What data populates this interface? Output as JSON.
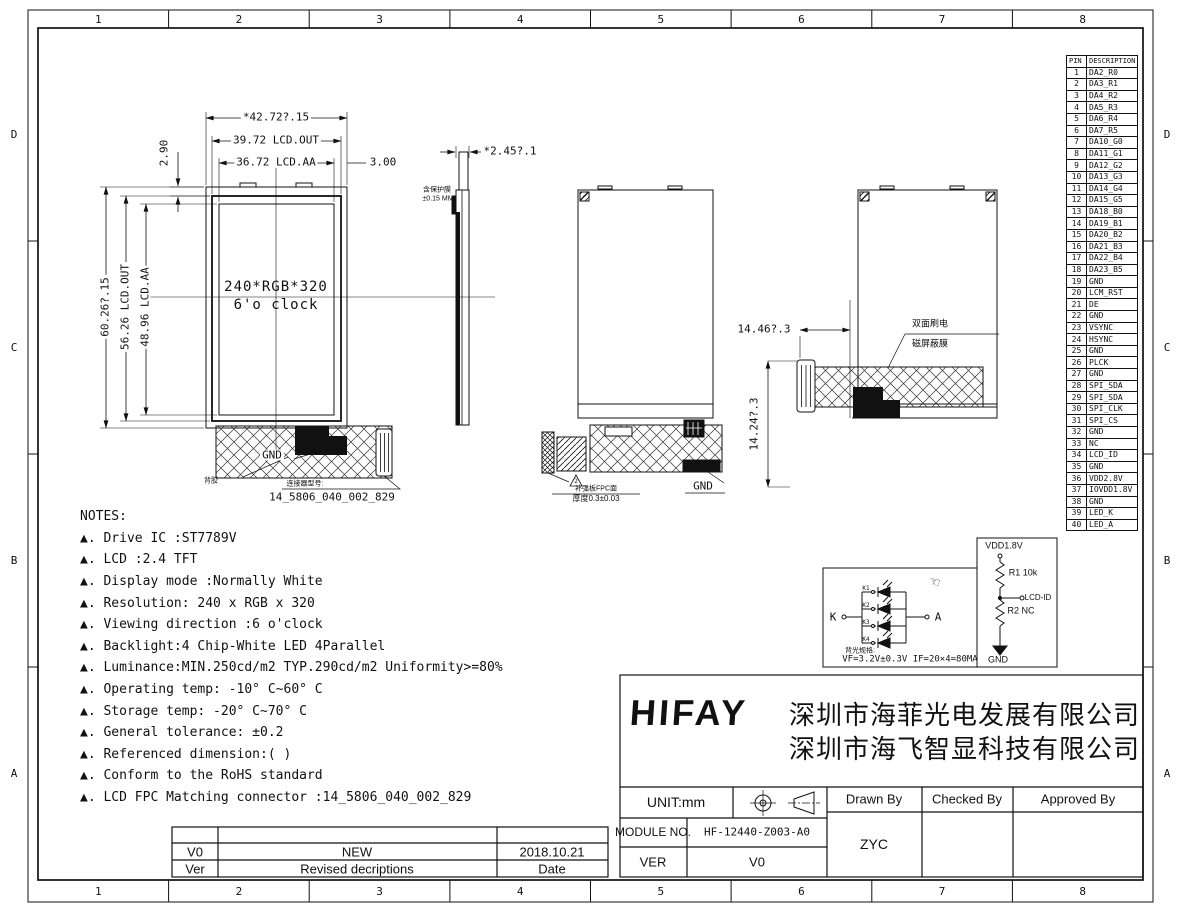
{
  "frame": {
    "cols": [
      "1",
      "2",
      "3",
      "4",
      "5",
      "6",
      "7",
      "8"
    ],
    "rows": [
      "D",
      "C",
      "B",
      "A"
    ]
  },
  "front_view": {
    "dim_width_total": "*42.72?.15",
    "dim_width_out": "39.72 LCD.OUT",
    "dim_width_aa": "36.72 LCD.AA",
    "dim_right_margin": "3.00",
    "dim_top": "2.90",
    "dim_height_total": "60.26?.15",
    "dim_height_out": "56.26 LCD.OUT",
    "dim_height_aa": "48.96 LCD.AA",
    "center_line1": "240*RGB*320",
    "center_line2": "6'o clock",
    "gnd_label": "GND",
    "adhesive_label": "背胶",
    "connector_label": "连接器型号:",
    "connector_pn": "14_5806_040_002_829"
  },
  "side_view": {
    "dim_thickness": "*2.45?.1",
    "note_line1": "含保护膜",
    "note_line2": "±0.15 MM"
  },
  "fold_view": {
    "gnd_label": "GND",
    "warn_num": "2",
    "fpc_note1": "补强板FPC面",
    "fpc_note2": "厚度0.3±0.03"
  },
  "shield_view": {
    "dim_h": "14.46?.3",
    "dim_v": "14.24?.3",
    "label_line1": "双面刷电",
    "label_line2": "磁屏蔽膜"
  },
  "pin_table": {
    "headers": [
      "PIN",
      "DESCRIPTION"
    ],
    "rows": [
      {
        "pin": "1",
        "desc": "DA2_R0"
      },
      {
        "pin": "2",
        "desc": "DA3_R1"
      },
      {
        "pin": "3",
        "desc": "DA4_R2"
      },
      {
        "pin": "4",
        "desc": "DA5_R3"
      },
      {
        "pin": "5",
        "desc": "DA6_R4"
      },
      {
        "pin": "6",
        "desc": "DA7_R5"
      },
      {
        "pin": "7",
        "desc": "DA10_G0"
      },
      {
        "pin": "8",
        "desc": "DA11_G1"
      },
      {
        "pin": "9",
        "desc": "DA12_G2"
      },
      {
        "pin": "10",
        "desc": "DA13_G3"
      },
      {
        "pin": "11",
        "desc": "DA14_G4"
      },
      {
        "pin": "12",
        "desc": "DA15_G5"
      },
      {
        "pin": "13",
        "desc": "DA18_B0"
      },
      {
        "pin": "14",
        "desc": "DA19_B1"
      },
      {
        "pin": "15",
        "desc": "DA20_B2"
      },
      {
        "pin": "16",
        "desc": "DA21_B3"
      },
      {
        "pin": "17",
        "desc": "DA22_B4"
      },
      {
        "pin": "18",
        "desc": "DA23_B5"
      },
      {
        "pin": "19",
        "desc": "GND"
      },
      {
        "pin": "20",
        "desc": "LCM_RST"
      },
      {
        "pin": "21",
        "desc": "DE"
      },
      {
        "pin": "22",
        "desc": "GND"
      },
      {
        "pin": "23",
        "desc": "VSYNC"
      },
      {
        "pin": "24",
        "desc": "HSYNC"
      },
      {
        "pin": "25",
        "desc": "GND"
      },
      {
        "pin": "26",
        "desc": "PLCK"
      },
      {
        "pin": "27",
        "desc": "GND"
      },
      {
        "pin": "28",
        "desc": "SPI_SDA"
      },
      {
        "pin": "29",
        "desc": "SPI_SDA"
      },
      {
        "pin": "30",
        "desc": "SPI_CLK"
      },
      {
        "pin": "31",
        "desc": "SPI_CS"
      },
      {
        "pin": "32",
        "desc": "GND"
      },
      {
        "pin": "33",
        "desc": "NC"
      },
      {
        "pin": "34",
        "desc": "LCD_ID"
      },
      {
        "pin": "35",
        "desc": "GND"
      },
      {
        "pin": "36",
        "desc": "VDD2.8V"
      },
      {
        "pin": "37",
        "desc": "IOVDD1.8V"
      },
      {
        "pin": "38",
        "desc": "GND"
      },
      {
        "pin": "39",
        "desc": "LED_K"
      },
      {
        "pin": "40",
        "desc": "LED_A"
      }
    ]
  },
  "notes": {
    "title": "NOTES:",
    "items": [
      "▲. Drive IC :ST7789V",
      "▲. LCD :2.4 TFT",
      "▲. Display mode :Normally White",
      "▲. Resolution: 240 x RGB x 320",
      "▲. Viewing direction :6 o'clock",
      "▲. Backlight:4 Chip-White LED 4Parallel",
      "▲. Luminance:MIN.250cd/m2 TYP.290cd/m2  Uniformity>=80%",
      "▲. Operating temp: -10° C~60° C",
      "▲. Storage temp: -20° C~70° C",
      "▲. General tolerance: ±0.2",
      "▲. Referenced dimension:( )",
      "▲. Conform to the RoHS standard",
      "▲. LCD FPC Matching connector :14_5806_040_002_829"
    ]
  },
  "led_circuit": {
    "k_label": "K",
    "a_label": "A",
    "k_labels": [
      "K1",
      "K2",
      "K3",
      "K4"
    ],
    "hand_icon": "☜",
    "spec_label": "背光规格:",
    "spec": "VF=3.2V±0.3V IF=20×4=80MA"
  },
  "pullup_circuit": {
    "vdd": "VDD1.8V",
    "r1": "R1 10k",
    "node": "LCD-ID",
    "r2": "R2 NC",
    "gnd": "GND"
  },
  "title_block": {
    "logo": "HIFAY",
    "company_line1": "深圳市海菲光电发展有限公司",
    "company_line2": "深圳市海飞智显科技有限公司",
    "unit": "UNIT:mm",
    "drawn_by_h": "Drawn By",
    "checked_by_h": "Checked By",
    "approved_by_h": "Approved By",
    "module_label": "MODULE NO.",
    "module_no": "HF-12440-Z003-A0",
    "ver_label": "VER",
    "ver": "V0",
    "drawn_by": "ZYC"
  },
  "revision_table": {
    "row": {
      "ver": "V0",
      "desc": "NEW",
      "date": "2018.10.21"
    },
    "header": {
      "ver": "Ver",
      "desc": "Revised decriptions",
      "date": "Date"
    }
  }
}
